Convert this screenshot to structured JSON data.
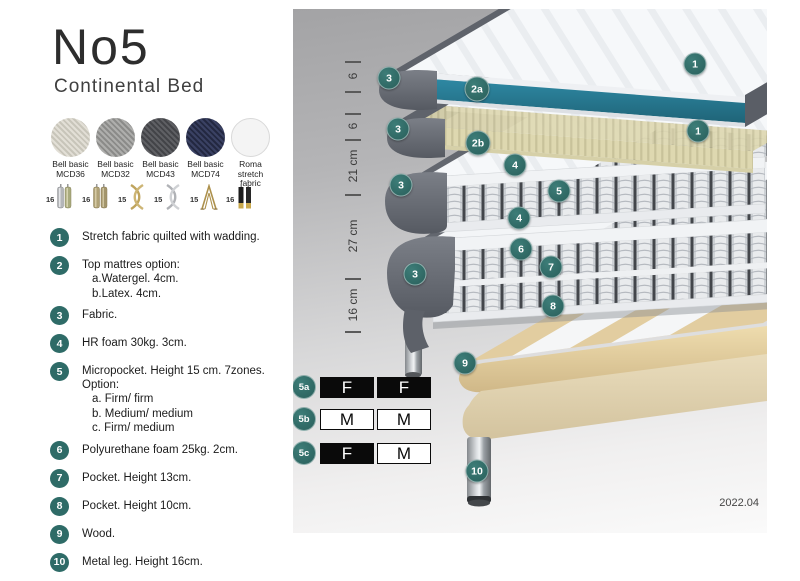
{
  "product": {
    "name": "No5",
    "subtitle": "Continental Bed"
  },
  "fabrics": [
    {
      "line1": "Bell basic",
      "line2": "MCD36"
    },
    {
      "line1": "Bell basic",
      "line2": "MCD32"
    },
    {
      "line1": "Bell basic",
      "line2": "MCD43"
    },
    {
      "line1": "Bell basic",
      "line2": "MCD74"
    },
    {
      "line1": "Roma",
      "line2": "stretch fabric"
    }
  ],
  "legs": [
    {
      "height": "16",
      "style": "cylinder-silver"
    },
    {
      "height": "16",
      "style": "cylinder-brass"
    },
    {
      "height": "15",
      "style": "twisted-gold"
    },
    {
      "height": "15",
      "style": "twisted-silver"
    },
    {
      "height": "15",
      "style": "hairpin-gold"
    },
    {
      "height": "16",
      "style": "cylinder-black-gold"
    }
  ],
  "features": [
    {
      "num": "1",
      "text": "Stretch fabric quilted with wadding."
    },
    {
      "num": "2",
      "text": "Top mattres option:",
      "sub": [
        "a.Watergel. 4cm.",
        "b.Latex. 4cm."
      ]
    },
    {
      "num": "3",
      "text": "Fabric."
    },
    {
      "num": "4",
      "text": "HR foam 30kg. 3cm."
    },
    {
      "num": "5",
      "text": "Micropocket. Height 15 cm. 7zones. Option:",
      "sub": [
        "a. Firm/ firm",
        "b. Medium/ medium",
        "c. Firm/ medium"
      ]
    },
    {
      "num": "6",
      "text": "Polyurethane foam 25kg. 2cm."
    },
    {
      "num": "7",
      "text": "Pocket. Height 13cm."
    },
    {
      "num": "8",
      "text": "Pocket. Height 10cm."
    },
    {
      "num": "9",
      "text": "Wood."
    },
    {
      "num": "10",
      "text": "Metal leg. Height 16cm."
    }
  ],
  "diagram": {
    "ruler": [
      "6",
      "6",
      "21 cm",
      "27 cm",
      "16 cm"
    ],
    "badges": [
      {
        "label": "1"
      },
      {
        "label": "3"
      },
      {
        "label": "2a"
      },
      {
        "label": "1"
      },
      {
        "label": "3"
      },
      {
        "label": "2b"
      },
      {
        "label": "4"
      },
      {
        "label": "3"
      },
      {
        "label": "5"
      },
      {
        "label": "4"
      },
      {
        "label": "6"
      },
      {
        "label": "3"
      },
      {
        "label": "7"
      },
      {
        "label": "8"
      },
      {
        "label": "9"
      },
      {
        "label": "10"
      }
    ],
    "firmness_rows": [
      {
        "id": "5a",
        "left": "F",
        "right": "F"
      },
      {
        "id": "5b",
        "left": "M",
        "right": "M"
      },
      {
        "id": "5c",
        "left": "F",
        "right": "M"
      }
    ],
    "version": "2022.04"
  },
  "colors": {
    "accent_teal": "#2e6b67",
    "watergel": "#2a7e98",
    "latex": "#ded8b0",
    "wood": "#e3cfa0",
    "fabric_gray": "#63676f"
  }
}
